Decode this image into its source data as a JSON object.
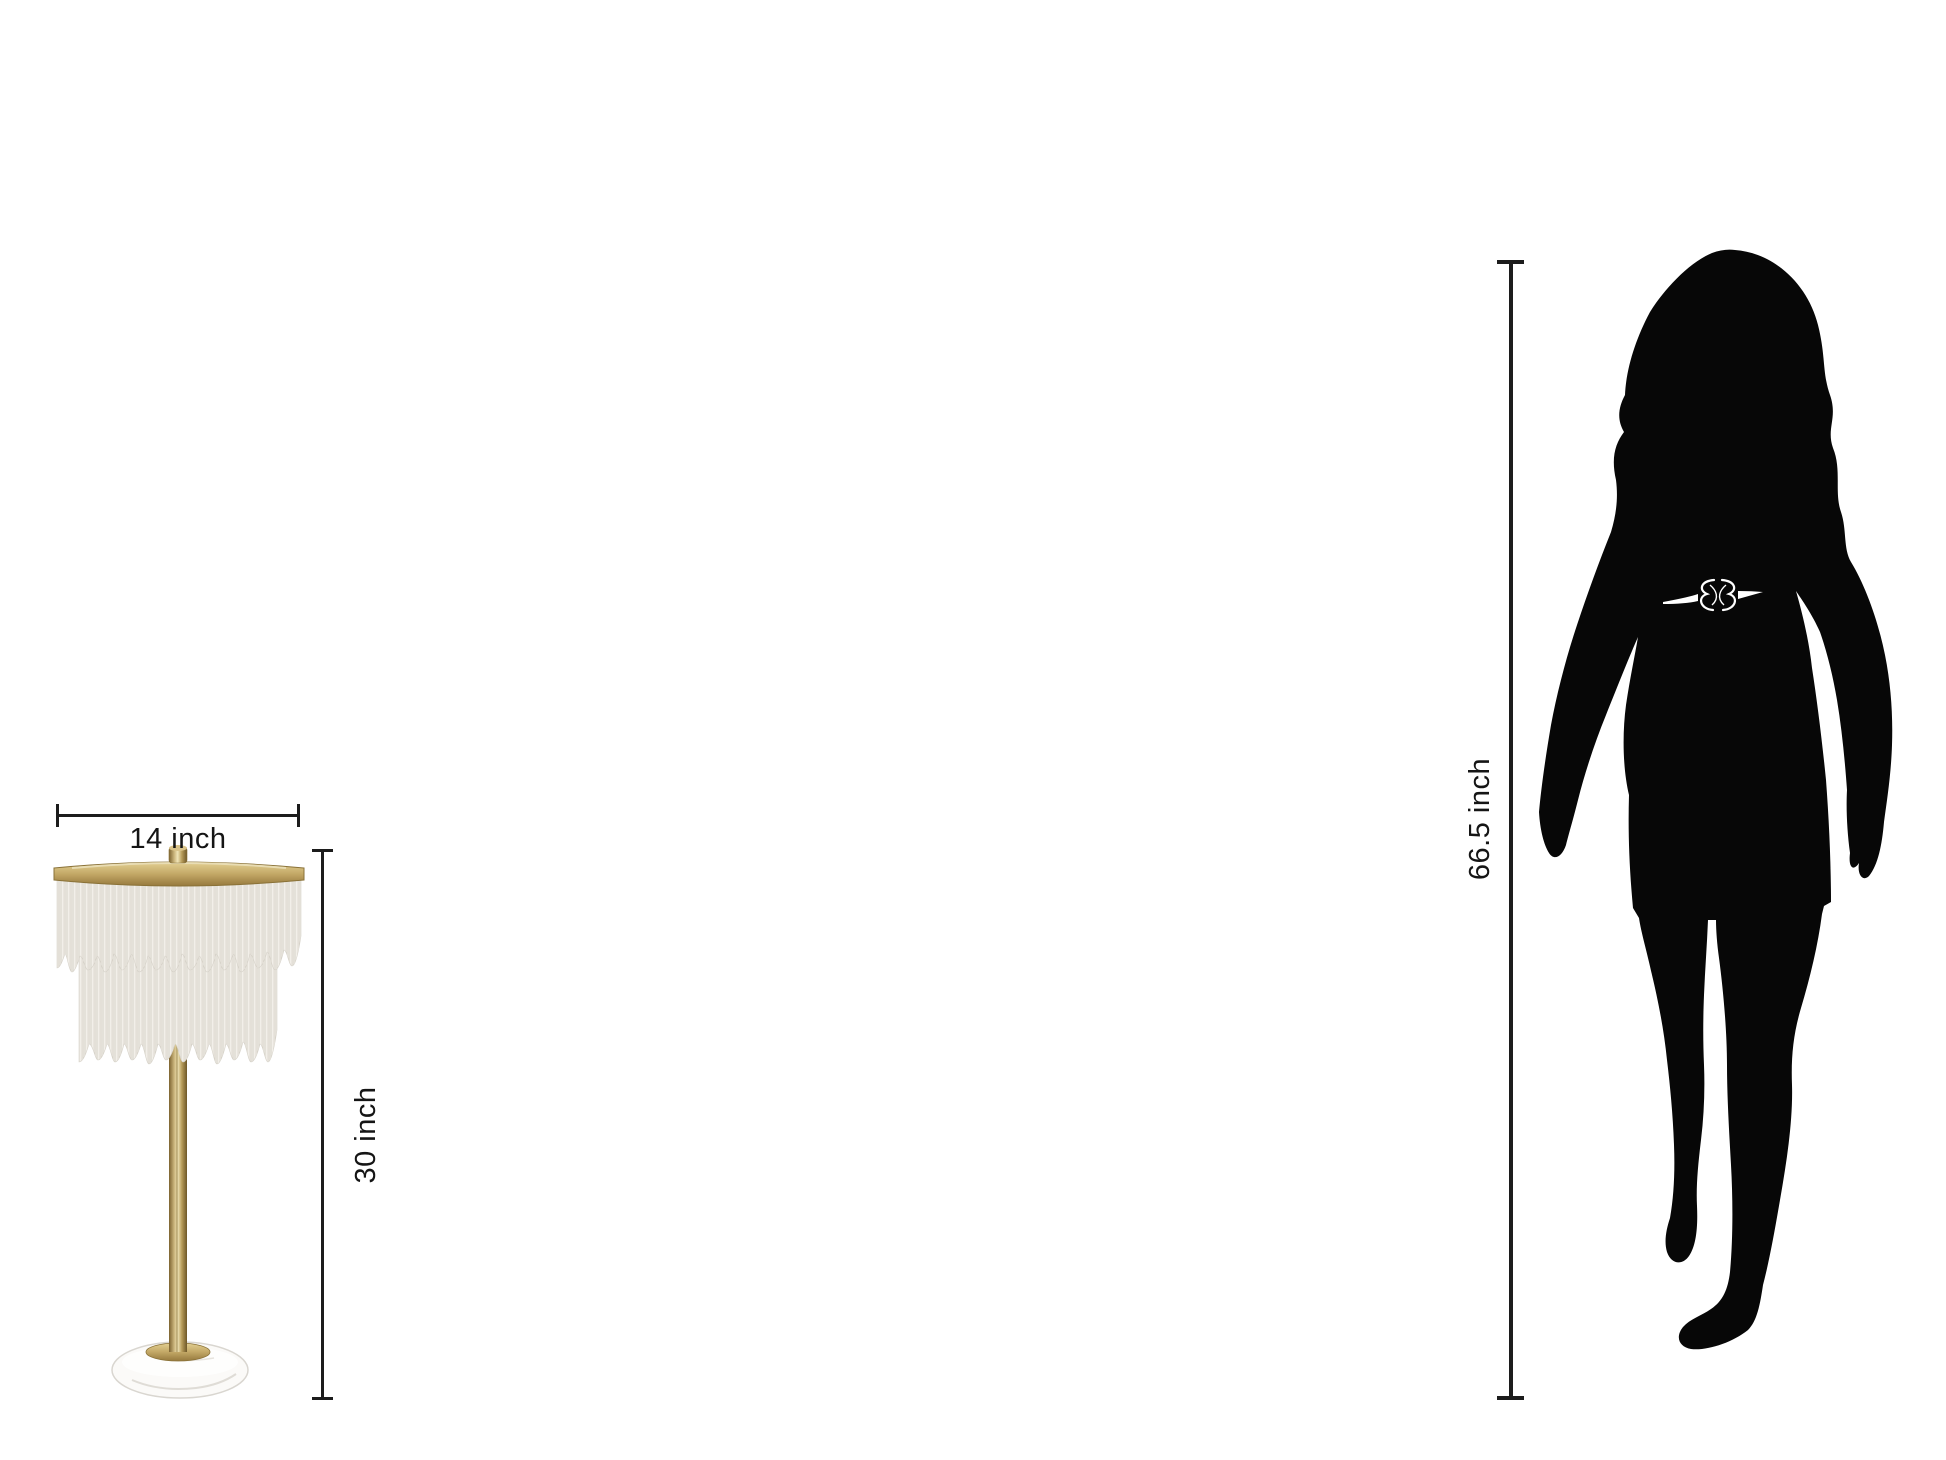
{
  "canvas": {
    "width": 1946,
    "height": 1460,
    "background": "#ffffff"
  },
  "object": {
    "type": "fringe-table-lamp",
    "width_dim": {
      "label": "14 inch"
    },
    "height_dim": {
      "label": "30 inch"
    }
  },
  "person": {
    "type": "woman-silhouette",
    "height_dim": {
      "label": "66.5 inch"
    }
  },
  "colors": {
    "dimension_line": "#1c1c1c",
    "label_text": "#151515",
    "silhouette": "#070707",
    "brass": "#c3a866",
    "brass_dark": "#96793d",
    "brass_light": "#e3d093",
    "fringe": "#f2efe9",
    "fringe_strand": "#d7d3ca",
    "marble": "#fbfaf8",
    "marble_edge": "#d9d6d0",
    "belt": "#ffffff"
  }
}
